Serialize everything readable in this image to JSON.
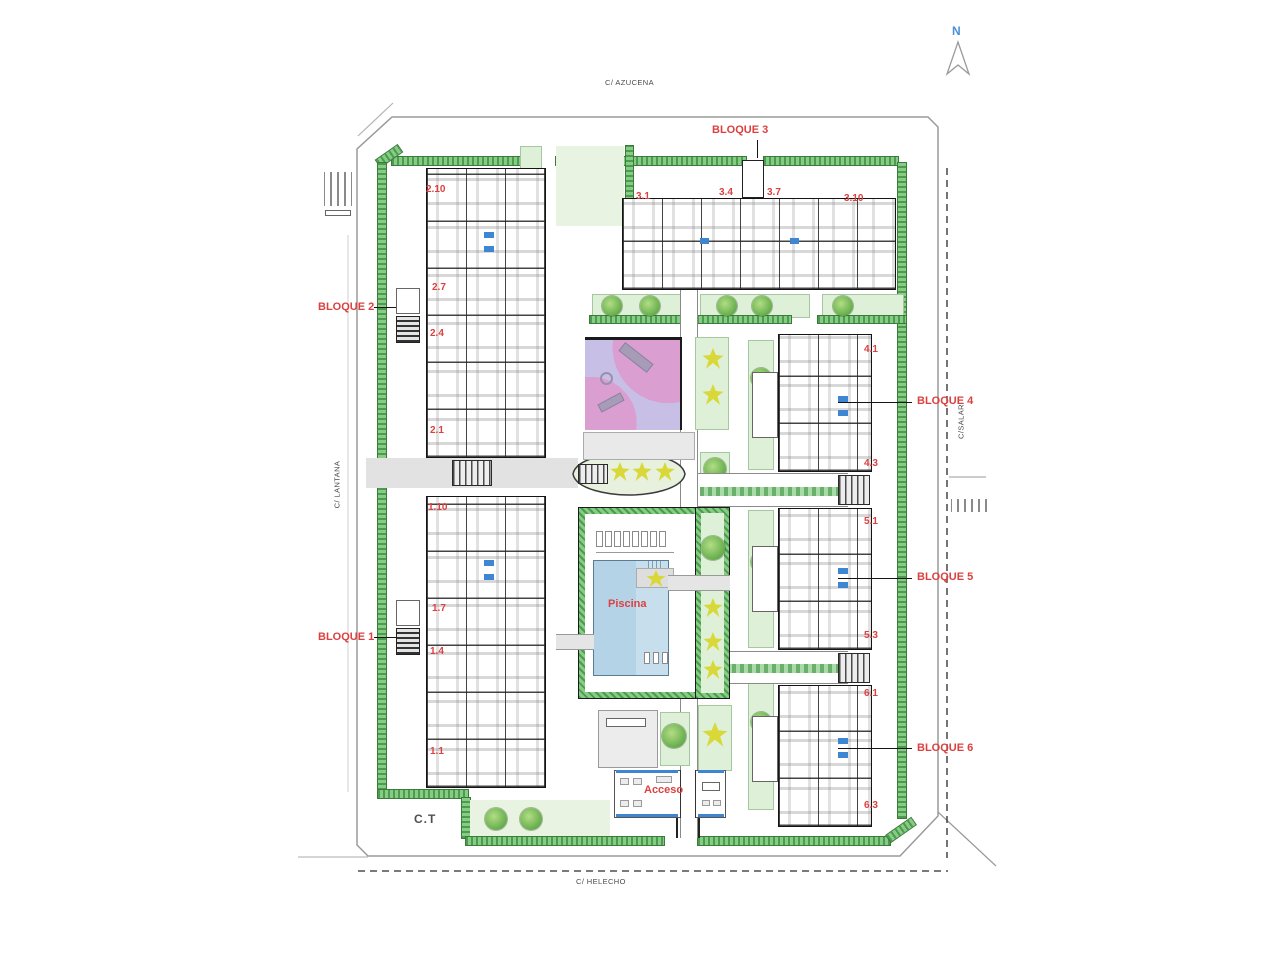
{
  "north_arrow": {
    "label": "N"
  },
  "streets": {
    "top": "C/ AZUCENA",
    "bottom": "C/ HELECHO",
    "left": "C/ LANTANA",
    "right": "C/SALAR"
  },
  "blocks": {
    "b1": {
      "label": "BLOQUE 1"
    },
    "b2": {
      "label": "BLOQUE 2"
    },
    "b3": {
      "label": "BLOQUE 3"
    },
    "b4": {
      "label": "BLOQUE 4"
    },
    "b5": {
      "label": "BLOQUE 5"
    },
    "b6": {
      "label": "BLOQUE 6"
    }
  },
  "units": {
    "u2_10": "2.10",
    "u2_7": "2.7",
    "u2_4": "2.4",
    "u2_1": "2.1",
    "u1_10": "1.10",
    "u1_7": "1.7",
    "u1_4": "1.4",
    "u1_1": "1.1",
    "u3_1": "3.1",
    "u3_4": "3.4",
    "u3_7": "3.7",
    "u3_10": "3.10",
    "u4_1": "4.1",
    "u4_3": "4.3",
    "u5_1": "5.1",
    "u5_3": "5.3",
    "u6_1": "6.1",
    "u6_3": "6.3"
  },
  "labels": {
    "pool": "Piscina",
    "access": "Acceso",
    "transformer": "C.T"
  },
  "colors": {
    "label_red": "#dc4140",
    "hedge_green": "#6fbc6f",
    "garden_green": "#def0d8",
    "pool_blue": "#b5d3e7",
    "playground_pink": "#db9ed1",
    "playground_purple": "#c7bfe5",
    "palm_yellow": "#d8d839",
    "north_blue": "#4a90d9",
    "line_gray": "#9a9a9a"
  }
}
